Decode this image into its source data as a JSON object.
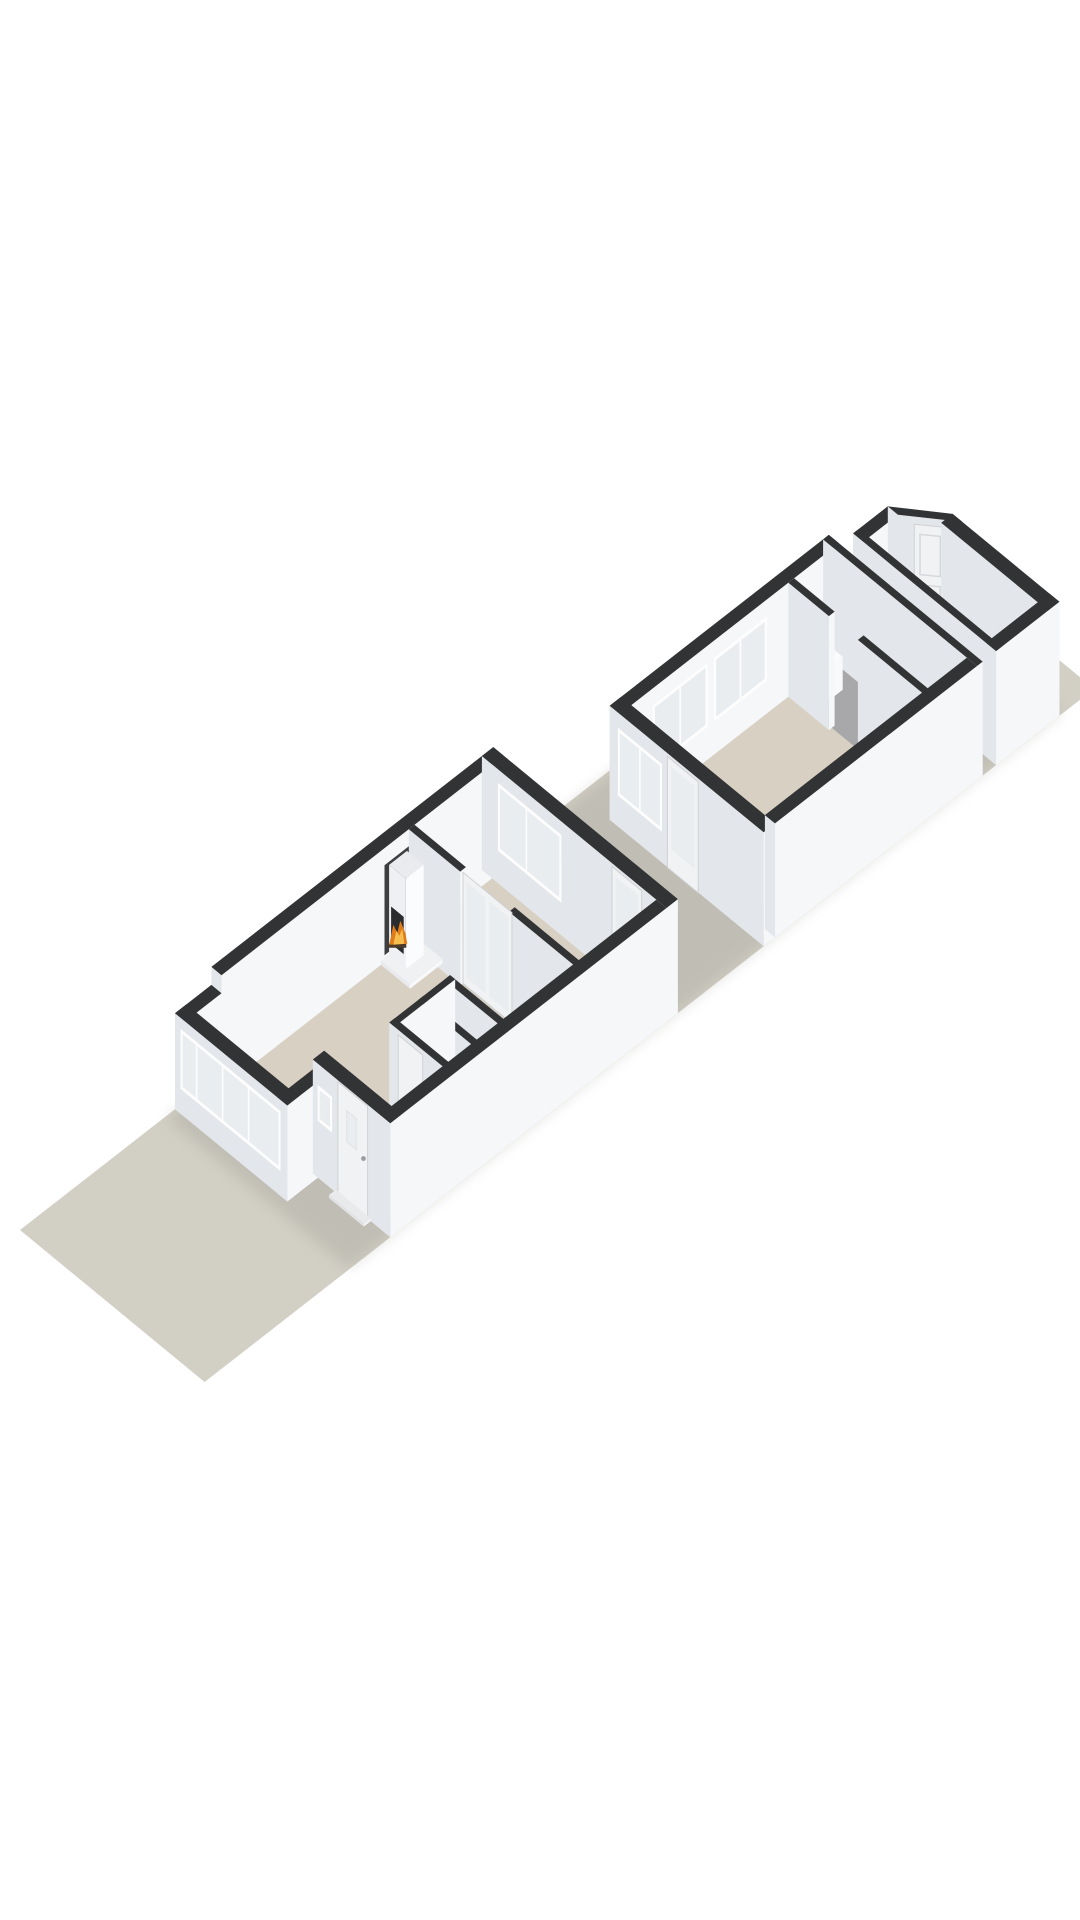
{
  "title_hint": "3d-floorplan-render",
  "scene": {
    "meta": {
      "ox": 20,
      "oy": 1230,
      "ux": 40.8,
      "uy": -31.8,
      "vx": 36.2,
      "vy": 29.8,
      "hz": 60
    },
    "colors": {
      "bg": "#ffffff",
      "lot": "#d2cfc5",
      "floor": "#d8d0c2",
      "floorGray": "#a8a8aa",
      "wallTop": "#323335",
      "sideLight": "#f6f7f9",
      "sideDark": "#e3e6ea",
      "frame": "#fdfdfe",
      "glass": "#e9edf0",
      "door": "#f1f2f4",
      "shadow": "#8e8c83",
      "recess": "#3d3e40",
      "stoveGlass": "#2b2c2e",
      "flameOuter": "#e07b1a",
      "flameInner": "#f6bd4f",
      "log": "#4a3a28"
    },
    "elements": [
      {
        "name": "lot-ground",
        "type": "poly",
        "pts": [
          [
            0,
            0
          ],
          [
            21.8,
            0
          ],
          [
            21.8,
            5.1
          ],
          [
            0,
            5.1
          ]
        ],
        "fill": "lot"
      },
      {
        "name": "house-shadow",
        "type": "shadow",
        "pts": [
          [
            3.55,
            0.05
          ],
          [
            21.05,
            0.05
          ],
          [
            21.05,
            5.08
          ],
          [
            3.55,
            5.08
          ]
        ],
        "fill": "shadow",
        "opacity": 0.25
      },
      {
        "name": "shed-floor",
        "type": "poly",
        "pts": [
          [
            19.55,
            1.43
          ],
          [
            20.2,
            1.43
          ],
          [
            20.8,
            2.32
          ],
          [
            20.8,
            4.92
          ],
          [
            19.55,
            4.92
          ]
        ],
        "fill": "floorGray"
      },
      {
        "name": "shed-wall-nw",
        "type": "prism",
        "pts": [
          [
            19.4,
            1.15
          ],
          [
            20.25,
            1.15
          ],
          [
            20.25,
            1.43
          ],
          [
            19.4,
            1.43
          ]
        ],
        "h": 1.9
      },
      {
        "name": "shed-wall-corner",
        "type": "prism",
        "pts": [
          [
            20.25,
            1.15
          ],
          [
            20.95,
            2.15
          ],
          [
            20.95,
            2.42
          ],
          [
            20.25,
            1.43
          ]
        ],
        "h": 1.9
      },
      {
        "name": "shed-door",
        "type": "door",
        "kind": "paneled",
        "p1": [
          20.42,
          1.69
        ],
        "p2": [
          20.77,
          2.17
        ],
        "h": 1.78
      },
      {
        "name": "shed-wall-ne",
        "type": "prism",
        "pts": [
          [
            20.67,
            2.15
          ],
          [
            20.95,
            2.15
          ],
          [
            20.95,
            5.1
          ],
          [
            20.67,
            5.1
          ]
        ],
        "h": 1.9
      },
      {
        "name": "shed-wall-se",
        "type": "prism",
        "pts": [
          [
            19.4,
            4.82
          ],
          [
            20.95,
            4.82
          ],
          [
            20.95,
            5.1
          ],
          [
            19.4,
            5.1
          ]
        ],
        "h": 1.9
      },
      {
        "name": "shed-wall-sw",
        "type": "prism",
        "pts": [
          [
            19.4,
            1.15
          ],
          [
            19.54,
            1.15
          ],
          [
            19.54,
            5.1
          ],
          [
            19.4,
            5.1
          ]
        ],
        "h": 1.9
      },
      {
        "name": "storage-floor",
        "type": "poly",
        "pts": [
          [
            17.9,
            1.13
          ],
          [
            18.93,
            1.13
          ],
          [
            18.93,
            4.92
          ],
          [
            17.9,
            4.92
          ]
        ],
        "fill": "floorGray"
      },
      {
        "name": "annex-floor",
        "type": "poly",
        "pts": [
          [
            13.84,
            1.13
          ],
          [
            17.9,
            1.13
          ],
          [
            17.9,
            4.92
          ],
          [
            13.84,
            4.92
          ]
        ],
        "fill": "floor"
      },
      {
        "name": "annex-wall-nw",
        "type": "prism",
        "pts": [
          [
            13.7,
            0.85
          ],
          [
            19.07,
            0.85
          ],
          [
            19.07,
            1.13
          ],
          [
            13.7,
            1.13
          ]
        ],
        "h": 1.9
      },
      {
        "name": "annex-window-nw-1",
        "type": "window",
        "p1": [
          14.5,
          1.135
        ],
        "p2": [
          15.85,
          1.135
        ],
        "h0": 0.55,
        "h1": 1.62,
        "mull": [
          0.5
        ]
      },
      {
        "name": "annex-window-nw-2",
        "type": "window",
        "p1": [
          16.0,
          1.135
        ],
        "p2": [
          17.3,
          1.135
        ],
        "h0": 0.55,
        "h1": 1.62,
        "mull": [
          0.5
        ]
      },
      {
        "name": "annex-wall-ne",
        "type": "prism",
        "pts": [
          [
            18.93,
            0.85
          ],
          [
            19.07,
            0.85
          ],
          [
            19.07,
            5.1
          ],
          [
            18.93,
            5.1
          ]
        ],
        "h": 1.9
      },
      {
        "name": "storage-cabinet",
        "type": "prism",
        "pts": [
          [
            18.1,
            1.2
          ],
          [
            18.62,
            1.2
          ],
          [
            18.62,
            1.74
          ],
          [
            18.1,
            1.74
          ]
        ],
        "h": 0.55,
        "top": "#fafbfc",
        "sideLight": "#f8f9fb",
        "sideDark": "#eceef1"
      },
      {
        "name": "storage-wall-a",
        "type": "prism",
        "pts": [
          [
            17.83,
            1.13
          ],
          [
            17.97,
            1.13
          ],
          [
            17.97,
            2.25
          ],
          [
            17.83,
            2.25
          ]
        ],
        "h": 1.9
      },
      {
        "name": "storage-wall-b",
        "type": "prism",
        "pts": [
          [
            17.83,
            3.05
          ],
          [
            17.97,
            3.05
          ],
          [
            17.97,
            4.92
          ],
          [
            17.83,
            4.92
          ]
        ],
        "h": 1.9
      },
      {
        "name": "annex-counter",
        "type": "prism",
        "pts": [
          [
            14.35,
            3.75
          ],
          [
            15.45,
            3.75
          ],
          [
            15.45,
            4.7
          ],
          [
            14.35,
            4.7
          ]
        ],
        "h": 0.72,
        "top": "#fafbfc",
        "sideLight": "#f8f9fb",
        "sideDark": "#eceef1"
      },
      {
        "name": "annex-cabinet",
        "type": "prism",
        "pts": [
          [
            15.65,
            3.85
          ],
          [
            16.5,
            3.85
          ],
          [
            16.5,
            4.65
          ],
          [
            15.65,
            4.65
          ]
        ],
        "h": 0.72,
        "top": "#fafbfc",
        "sideLight": "#f8f9fb",
        "sideDark": "#eceef1"
      },
      {
        "name": "annex-wall-front",
        "type": "prism",
        "pts": [
          [
            13.7,
            0.85
          ],
          [
            13.98,
            0.85
          ],
          [
            13.98,
            5.1
          ],
          [
            13.7,
            5.1
          ]
        ],
        "h": 1.9
      },
      {
        "name": "annex-window-front",
        "type": "window",
        "p1": [
          13.695,
          1.08
        ],
        "p2": [
          13.695,
          2.3
        ],
        "h0": 0.52,
        "h1": 1.65,
        "mull": [
          0.5
        ]
      },
      {
        "name": "annex-door",
        "type": "door",
        "kind": "glazed",
        "p1": [
          13.695,
          2.45
        ],
        "p2": [
          13.695,
          3.3
        ],
        "h": 1.85
      },
      {
        "name": "annex-wall-se",
        "type": "prism",
        "pts": [
          [
            13.98,
            4.82
          ],
          [
            18.93,
            4.82
          ],
          [
            18.93,
            5.1
          ],
          [
            13.98,
            5.1
          ]
        ],
        "h": 1.9
      },
      {
        "name": "living-floor",
        "type": "poly",
        "pts": [
          [
            4.08,
            0.28
          ],
          [
            11.45,
            0.28
          ],
          [
            11.45,
            4.92
          ],
          [
            4.83,
            4.92
          ],
          [
            4.83,
            2.96
          ],
          [
            4.08,
            2.96
          ]
        ],
        "fill": "floor"
      },
      {
        "name": "main-wall-nw",
        "type": "prism",
        "pts": [
          [
            4.69,
            0
          ],
          [
            11.6,
            0
          ],
          [
            11.6,
            0.28
          ],
          [
            4.69,
            0.28
          ]
        ],
        "h": 1.9
      },
      {
        "name": "chimney-recess",
        "type": "panel",
        "p1": [
          8.68,
          0.285
        ],
        "p2": [
          9.32,
          0.285
        ],
        "h0": 0.12,
        "h1": 1.62,
        "fill": "recess"
      },
      {
        "name": "main-wall-ne",
        "type": "prism",
        "pts": [
          [
            11.32,
            0
          ],
          [
            11.6,
            0
          ],
          [
            11.6,
            5.1
          ],
          [
            11.32,
            5.1
          ]
        ],
        "h": 1.9
      },
      {
        "name": "rear-window",
        "type": "window",
        "p1": [
          11.315,
          0.45
        ],
        "p2": [
          11.315,
          2.2
        ],
        "h0": 0.55,
        "h1": 1.68,
        "mull": [
          0.45
        ]
      },
      {
        "name": "rear-door",
        "type": "door",
        "kind": "glazed",
        "p1": [
          11.315,
          3.6
        ],
        "p2": [
          11.315,
          4.42
        ],
        "h": 1.85
      },
      {
        "name": "cross-wall-a",
        "type": "prism",
        "pts": [
          [
            9.28,
            0.28
          ],
          [
            9.42,
            0.28
          ],
          [
            9.42,
            1.7
          ],
          [
            9.28,
            1.7
          ]
        ],
        "h": 1.9
      },
      {
        "name": "cross-wall-b",
        "type": "prism",
        "pts": [
          [
            9.28,
            3.05
          ],
          [
            9.42,
            3.05
          ],
          [
            9.42,
            4.92
          ],
          [
            9.28,
            4.92
          ]
        ],
        "h": 1.9
      },
      {
        "name": "glass-double-doors",
        "type": "door",
        "kind": "double-glass",
        "p1": [
          9.35,
          1.7
        ],
        "p2": [
          9.35,
          3.05
        ],
        "h": 1.85
      },
      {
        "name": "fireplace-hearth",
        "type": "prism",
        "pts": [
          [
            8.6,
            0.28
          ],
          [
            9.4,
            0.28
          ],
          [
            9.4,
            1.08
          ],
          [
            8.6,
            1.08
          ]
        ],
        "h": 0.07,
        "top": "#f0f1f3",
        "sideLight": "#f8f9fb",
        "sideDark": "#e8eaed"
      },
      {
        "name": "fireplace-stove",
        "type": "prism",
        "pts": [
          [
            8.78,
            0.3
          ],
          [
            9.22,
            0.3
          ],
          [
            9.22,
            0.76
          ],
          [
            8.78,
            0.76
          ]
        ],
        "h0": 0.07,
        "h": 1.58,
        "top": "#e9ebee",
        "sideLight": "#fbfcfd",
        "sideDark": "#eef0f3"
      },
      {
        "name": "fireplace-glass",
        "type": "panel",
        "p1": [
          8.775,
          0.36
        ],
        "p2": [
          8.775,
          0.71
        ],
        "h0": 0.3,
        "h1": 0.92,
        "fill": "stoveGlass"
      },
      {
        "name": "fireplace-flame",
        "type": "flame",
        "at": [
          8.773,
          0.535,
          0.52
        ]
      },
      {
        "name": "wc-wall-back",
        "type": "prism",
        "pts": [
          [
            7.43,
            3.35
          ],
          [
            7.57,
            3.35
          ],
          [
            7.57,
            4.92
          ],
          [
            7.43,
            4.92
          ]
        ],
        "h": 1.9
      },
      {
        "name": "wc-wall-mid",
        "type": "prism",
        "pts": [
          [
            6.78,
            3.35
          ],
          [
            6.92,
            3.35
          ],
          [
            6.92,
            4.92
          ],
          [
            6.78,
            4.92
          ]
        ],
        "h": 1.9
      },
      {
        "name": "wc-wall-nw",
        "type": "prism",
        "pts": [
          [
            6.08,
            3.35
          ],
          [
            7.57,
            3.35
          ],
          [
            7.57,
            3.49
          ],
          [
            6.08,
            3.49
          ]
        ],
        "h": 1.9
      },
      {
        "name": "wc-wall-front",
        "type": "prism",
        "pts": [
          [
            6.08,
            3.35
          ],
          [
            6.22,
            3.35
          ],
          [
            6.22,
            4.92
          ],
          [
            6.08,
            4.92
          ]
        ],
        "h": 1.9
      },
      {
        "name": "wc-door",
        "type": "door",
        "kind": "solid",
        "p1": [
          6.075,
          3.6
        ],
        "p2": [
          6.075,
          4.28
        ],
        "h": 1.82
      },
      {
        "name": "main-wall-se",
        "type": "prism",
        "pts": [
          [
            4.55,
            4.82
          ],
          [
            11.32,
            4.82
          ],
          [
            11.32,
            5.1
          ],
          [
            4.55,
            5.1
          ]
        ],
        "h": 1.9
      },
      {
        "name": "bay-wall-nw",
        "type": "prism",
        "pts": [
          [
            3.8,
            0
          ],
          [
            4.69,
            0
          ],
          [
            4.69,
            0.28
          ],
          [
            3.8,
            0.28
          ]
        ],
        "h": 1.6
      },
      {
        "name": "bay-wall-se",
        "type": "prism",
        "pts": [
          [
            3.8,
            2.82
          ],
          [
            4.69,
            2.82
          ],
          [
            4.69,
            3.1
          ],
          [
            3.8,
            3.1
          ]
        ],
        "h": 1.6
      },
      {
        "name": "bay-wall-front",
        "type": "prism",
        "pts": [
          [
            3.8,
            0
          ],
          [
            4.08,
            0
          ],
          [
            4.08,
            3.1
          ],
          [
            3.8,
            3.1
          ]
        ],
        "h": 1.6
      },
      {
        "name": "bay-window-band",
        "type": "window",
        "p1": [
          3.795,
          0.16
        ],
        "p2": [
          3.795,
          2.92
        ],
        "h0": 0.42,
        "h1": 1.42,
        "mull": [
          0.16,
          0.42,
          0.68
        ]
      },
      {
        "name": "entry-wall-front",
        "type": "prism",
        "pts": [
          [
            4.55,
            2.96
          ],
          [
            4.83,
            2.96
          ],
          [
            4.83,
            5.1
          ],
          [
            4.55,
            5.1
          ]
        ],
        "h": 1.9
      },
      {
        "name": "entry-window",
        "type": "window",
        "p1": [
          4.545,
          3.1
        ],
        "p2": [
          4.545,
          3.5
        ],
        "h0": 0.95,
        "h1": 1.55
      },
      {
        "name": "front-door",
        "type": "door",
        "kind": "solid",
        "p1": [
          4.545,
          3.66
        ],
        "p2": [
          4.545,
          4.48
        ],
        "h": 1.88,
        "glass": [
          0.3,
          0.62,
          1.0,
          1.52
        ],
        "handle": [
          0.86,
          0.95
        ]
      },
      {
        "name": "doorstep",
        "type": "prism",
        "pts": [
          [
            4.38,
            3.6
          ],
          [
            4.55,
            3.6
          ],
          [
            4.55,
            4.56
          ],
          [
            4.38,
            4.56
          ]
        ],
        "h": 0.05,
        "top": "#e9eaec",
        "sideLight": "#f2f3f5",
        "sideDark": "#e2e3e6"
      }
    ]
  }
}
